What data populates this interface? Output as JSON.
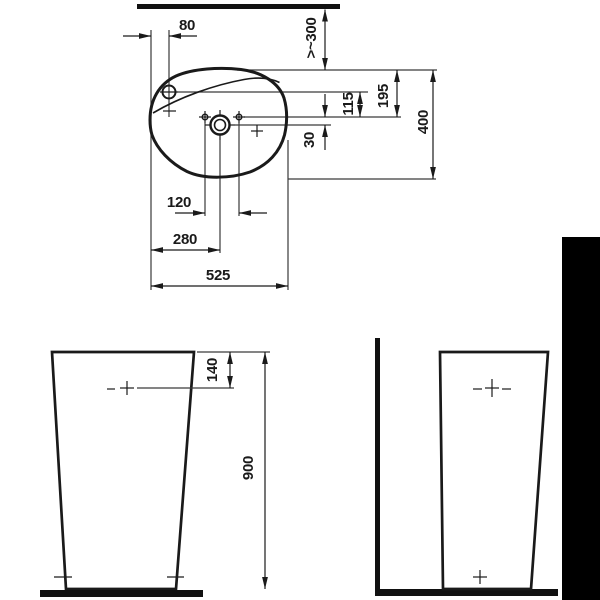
{
  "colors": {
    "ink": "#1a1a1a",
    "paper": "#ffffff",
    "edge_band": "#000000"
  },
  "dims": {
    "top_view": {
      "tap_offset": "80",
      "wall_distance": ">~300",
      "rim_to_holes": "195",
      "tap_to_holes": "115",
      "holes_to_drain": "30",
      "depth": "400",
      "holes_span": "120",
      "edge_to_drain": "280",
      "width": "525"
    },
    "front_view": {
      "rim_to_tap": "140",
      "height": "900"
    }
  }
}
